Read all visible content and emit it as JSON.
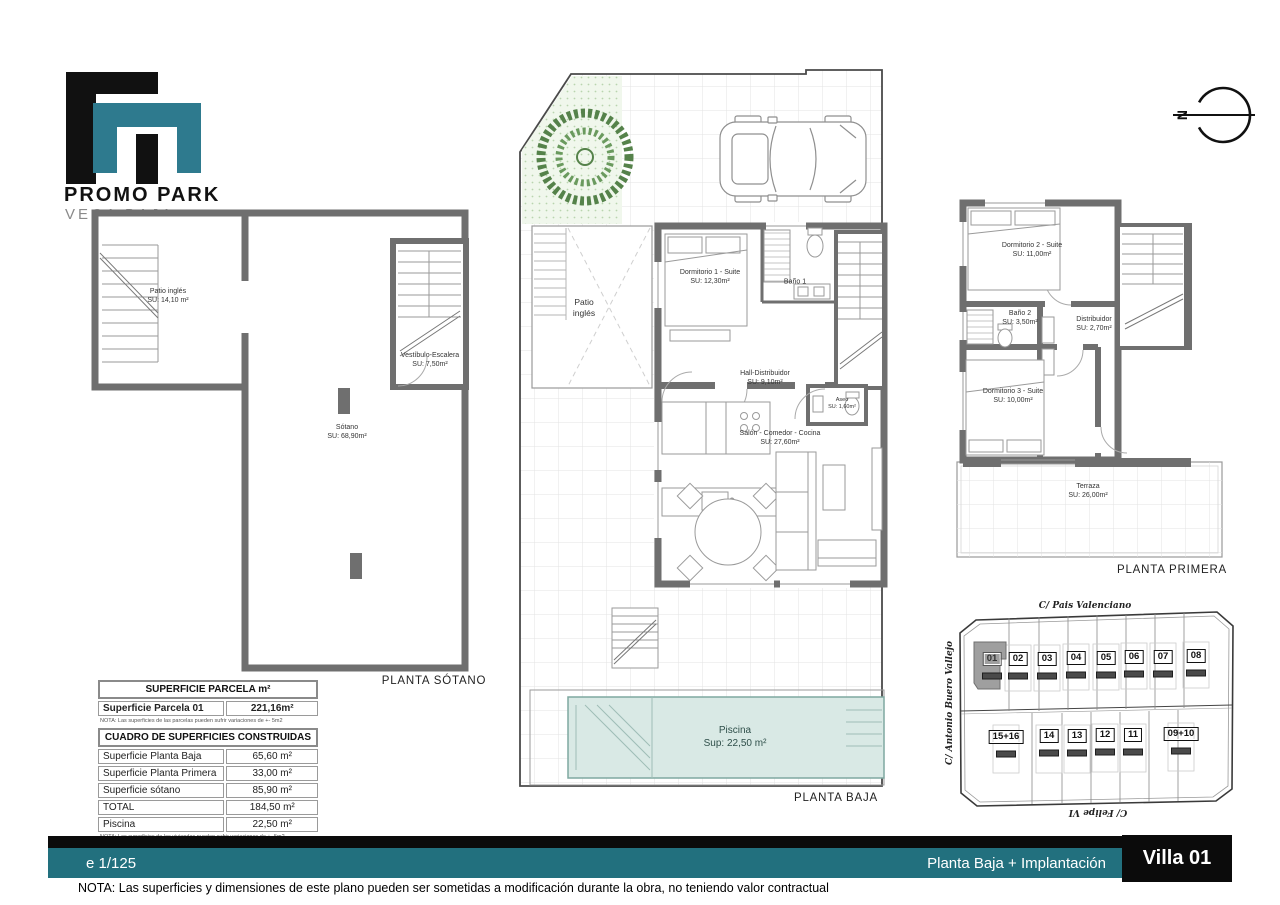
{
  "logo": {
    "title": "PROMO PARK",
    "subtitle": "VEGA BAJA"
  },
  "north": {
    "label": "N"
  },
  "plans": {
    "sotano": {
      "title": "PLANTA SÓTANO",
      "rooms": [
        {
          "name": "Patio inglés",
          "area": "SU: 14,10 m²"
        },
        {
          "name": "Vestíbulo-Escalera",
          "area": "SU: 7,50m²"
        },
        {
          "name": "Sótano",
          "area": "SU: 68,90m²"
        }
      ]
    },
    "baja": {
      "title": "PLANTA BAJA",
      "rooms": [
        {
          "name": "Patio inglés",
          "area": ""
        },
        {
          "name": "Dormitorio 1 - Suite",
          "area": "SU: 12,30m²"
        },
        {
          "name": "Baño 1",
          "area": ""
        },
        {
          "name": "Hall-Distribuidor",
          "area": "SU: 9,10m²"
        },
        {
          "name": "Aseo",
          "area": "SU: 1,60m²"
        },
        {
          "name": "Salón - Comedor - Cocina",
          "area": "SU: 27,60m²"
        },
        {
          "name": "Piscina",
          "area": "Sup: 22,50 m²"
        }
      ]
    },
    "primera": {
      "title": "PLANTA PRIMERA",
      "rooms": [
        {
          "name": "Dormitorio 2 - Suite",
          "area": "SU: 11,00m²"
        },
        {
          "name": "Baño 2",
          "area": "SU: 3,50m²"
        },
        {
          "name": "Distribuidor",
          "area": "SU: 2,70m²"
        },
        {
          "name": "Dormitorio 3 - Suite",
          "area": "SU: 10,00m²"
        },
        {
          "name": "Terraza",
          "area": "SU: 26,00m²"
        }
      ]
    }
  },
  "site": {
    "streets": {
      "top": "C/ Pais Valenciano",
      "left": "C/ Antonio Buero Vallejo",
      "bottom": "C/ Felipe VI"
    },
    "top_row": [
      "01",
      "02",
      "03",
      "04",
      "05",
      "06",
      "07",
      "08"
    ],
    "bottom_row": [
      "15+16",
      "14",
      "13",
      "12",
      "11",
      "09+10"
    ],
    "highlighted": "01"
  },
  "tables": {
    "parcela": {
      "header": "SUPERFICIE PARCELA m²",
      "rows": [
        {
          "label": "Superficie Parcela 01",
          "value": "221,16m²"
        }
      ],
      "note": "NOTA: Las superficies de las parcelas pueden sufrir variaciones de +- 5m2"
    },
    "construidas": {
      "header": "CUADRO DE SUPERFICIES CONSTRUIDAS",
      "rows": [
        {
          "label": "Superficie Planta Baja",
          "value": "65,60 m²"
        },
        {
          "label": "Superficie Planta Primera",
          "value": "33,00 m²"
        },
        {
          "label": "Superficie sótano",
          "value": "85,90 m²"
        },
        {
          "label": "TOTAL",
          "value": "184,50 m²"
        },
        {
          "label": "Piscina",
          "value": "22,50 m²"
        }
      ],
      "note": "NOTA: Las superficies de las viviendas pueden sufrir variaciones de +- 5m2"
    }
  },
  "footer": {
    "scale": "e 1/125",
    "sheet_title": "Planta Baja + Implantación",
    "villa": "Villa 01",
    "note": "NOTA: Las superficies y dimensiones de este plano pueden ser sometidas a modificación durante la obra, no teniendo valor contractual"
  },
  "colors": {
    "teal_bar": "#22707e",
    "logo_teal": "#2e7a8e",
    "wall_gray": "#6f6f6f",
    "pool": "#d9e9e5",
    "highlight_plot": "#9f9f9f"
  }
}
